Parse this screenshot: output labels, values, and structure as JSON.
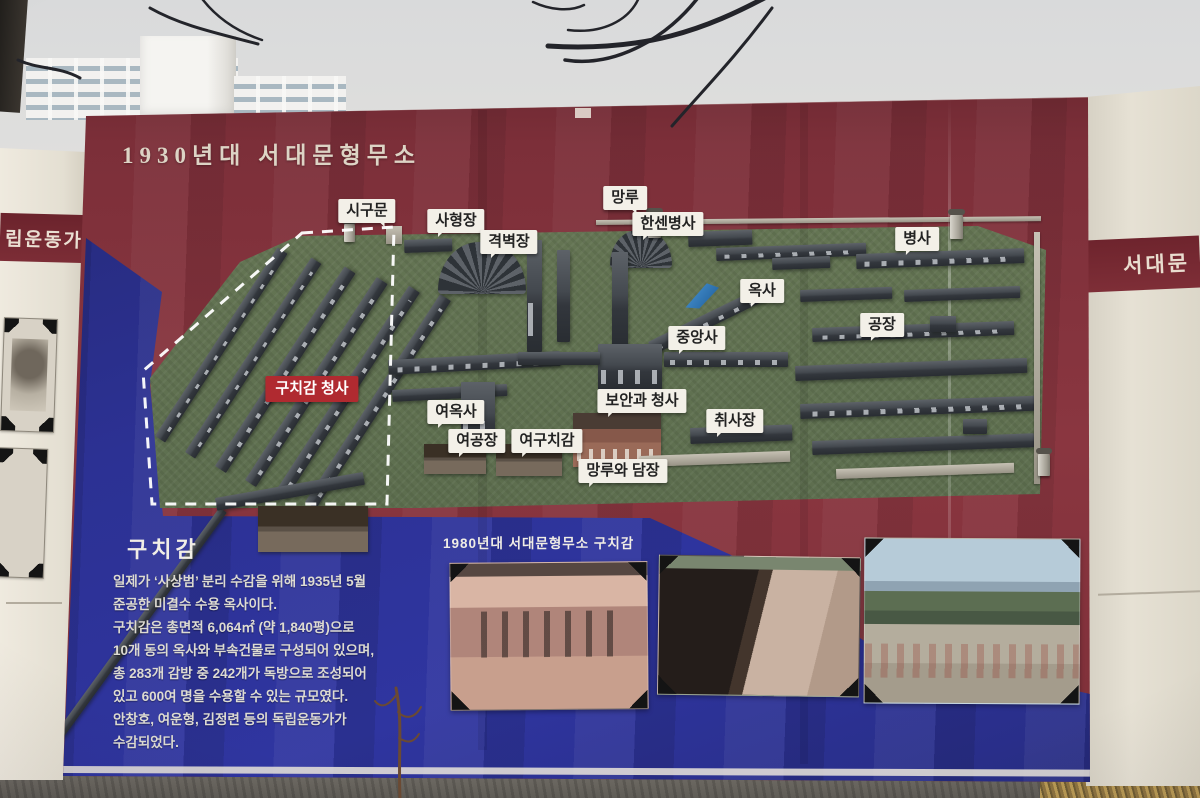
{
  "scene": {
    "description": "photograph of an outdoor information billboard"
  },
  "billboard": {
    "title": "1930년대 서대문형무소",
    "colors": {
      "panel_red": "#7d2f38",
      "panel_blue": "#2c3193",
      "map_green": "#5f7050",
      "label_bg": "#f3f0e8",
      "highlight_red": "#b02a30"
    },
    "map": {
      "labels": [
        "시구문",
        "사형장",
        "격벽장",
        "망루",
        "한센병사",
        "병사",
        "옥사",
        "공장",
        "중앙사",
        "여옥사",
        "보안과 청사",
        "취사장",
        "여공장",
        "여구치감",
        "망루와 담장"
      ],
      "highlight_label": "구치감 청사"
    },
    "info": {
      "heading": "구치감",
      "lines": [
        "일제가 ‘사상범’ 분리 수감을 위해 1935년 5월",
        "준공한 미결수 수용 옥사이다.",
        "구치감은 총면적 6,064㎡ (약 1,840평)으로",
        "10개 동의 옥사와 부속건물로 구성되어 있으며,",
        "총 283개 감방 중 242개가 독방으로 조성되어",
        "있고 600여 명을 수용할 수 있는 규모였다.",
        "안창호, 여운형, 김정련 등의 독립운동가가",
        "수감되었다."
      ]
    },
    "photo_section": {
      "caption": "1980년대 서대문형무소 구치감"
    }
  },
  "left_sign": {
    "band_text": "립운동가"
  },
  "right_sign": {
    "band_text": "서대문"
  }
}
